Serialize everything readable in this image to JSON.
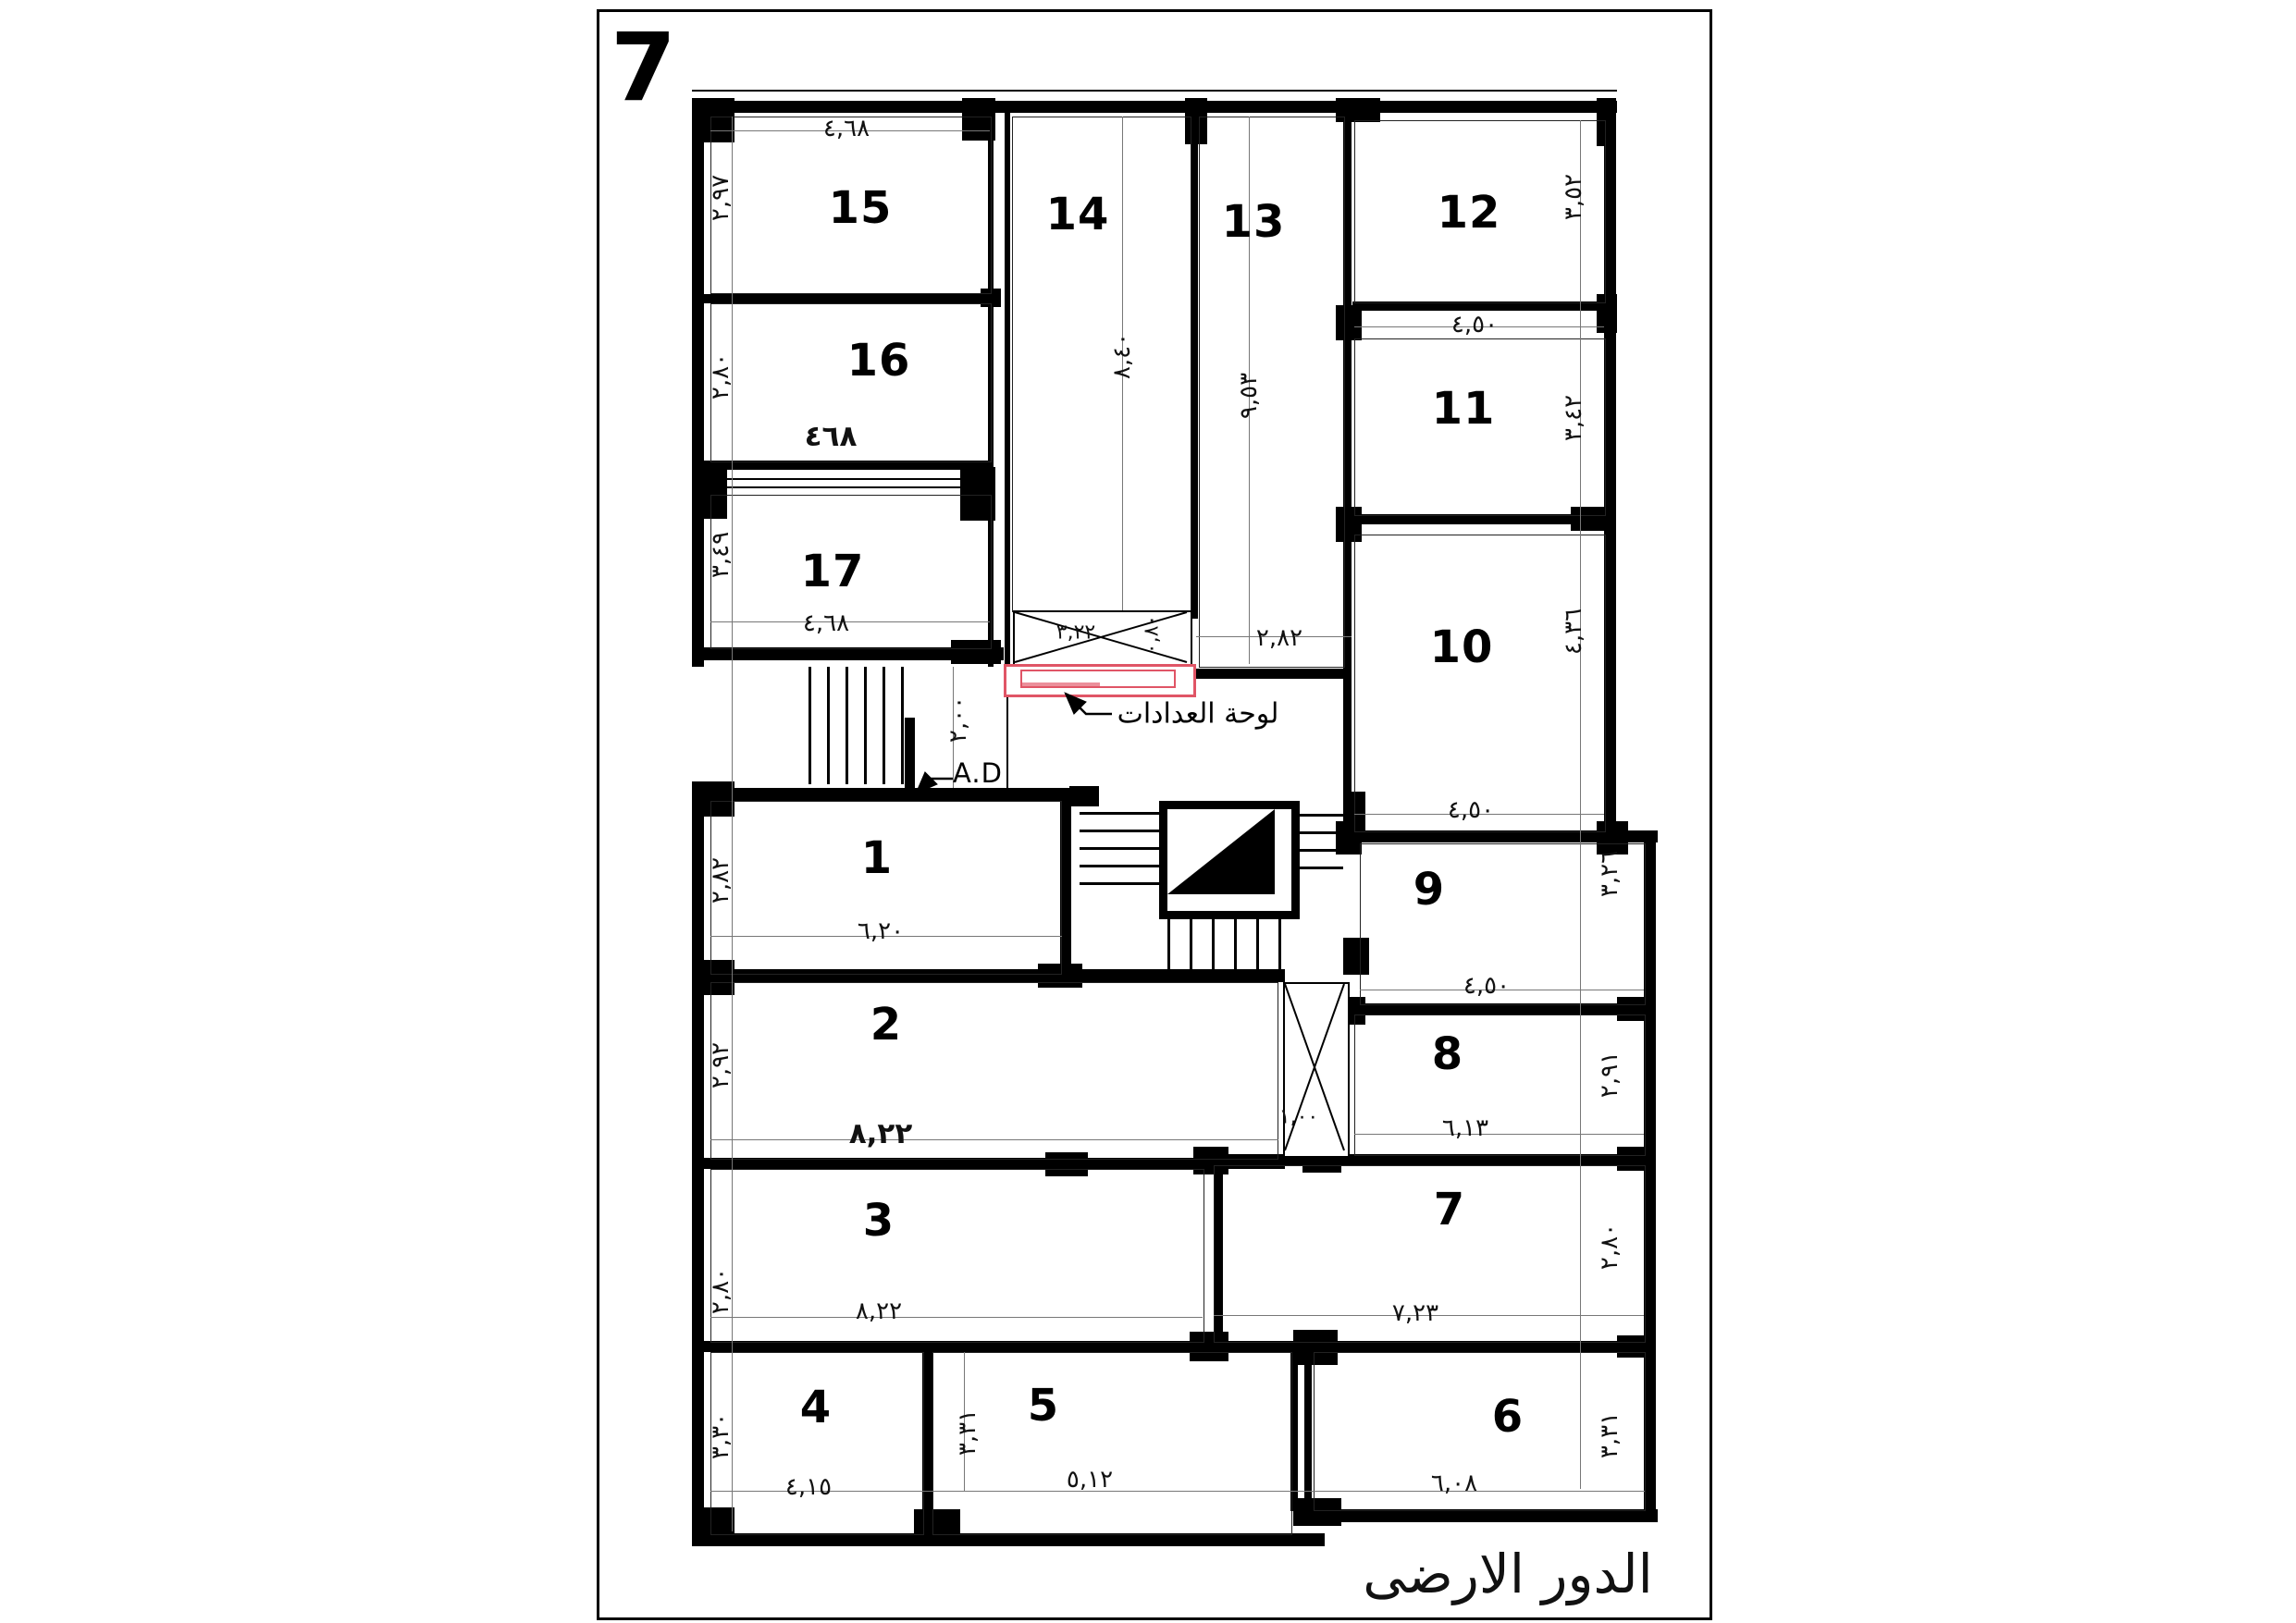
{
  "sheet": {
    "number": "7",
    "title": "الدور الارضى"
  },
  "labels": {
    "meters_panel": "لوحة العدادات",
    "air_duct": "A.D"
  },
  "colors": {
    "walls": "#000000",
    "meters_panel_accent": "#e05566",
    "dim_text": "#111111"
  },
  "rooms": {
    "r1": {
      "number": "1",
      "side": "٢,٨٢",
      "bottom": "٦,٢٠"
    },
    "r2": {
      "number": "2",
      "side": "٢,٩٢",
      "bottom": "٨,٢٢"
    },
    "r3": {
      "number": "3",
      "side": "٢,٨٠",
      "bottom": "٨,٢٢"
    },
    "r4": {
      "number": "4",
      "side": "٣,٣٠",
      "bottom": "٤,١٥"
    },
    "r5": {
      "number": "5",
      "side": "٣,٣١",
      "bottom": "٥,١٢"
    },
    "r6": {
      "number": "6",
      "side": "٣,٣١",
      "bottom": "٦,٠٨"
    },
    "r7": {
      "number": "7",
      "side": "٢,٨٠",
      "bottom": "٧,٢٣"
    },
    "r8": {
      "number": "8",
      "side": "٢,٩١",
      "bottom": "٦,١٣"
    },
    "r9": {
      "number": "9",
      "side": "٣,٢٦",
      "bottom": "٤,٥٠"
    },
    "r10": {
      "number": "10",
      "side": "٤,٣٦",
      "bottom": "٤,٥٠"
    },
    "r11": {
      "number": "11",
      "side": "٣,٤٢",
      "top": "٤,٥٠"
    },
    "r12": {
      "number": "12",
      "side": "٣,٥٢"
    },
    "r13": {
      "number": "13",
      "height": "٩,٥٣",
      "bottom": "٢,٨٢"
    },
    "r14": {
      "number": "14",
      "height": "٨,٤٠"
    },
    "r15": {
      "number": "15",
      "side": "٢,٩٧",
      "top": "٤,٦٨"
    },
    "r16": {
      "number": "16",
      "side": "٢,٨٠",
      "bottom": "٤٦٨"
    },
    "r17": {
      "number": "17",
      "side": "٣,٤٩",
      "bottom": "٤,٦٨"
    }
  },
  "stair": {
    "hall_dim": "٢,٠٠"
  },
  "shafts": {
    "top": {
      "width": "٣,٢٢",
      "depth": "٠,٨٠"
    },
    "side": {
      "width": "١,٠٠"
    }
  }
}
